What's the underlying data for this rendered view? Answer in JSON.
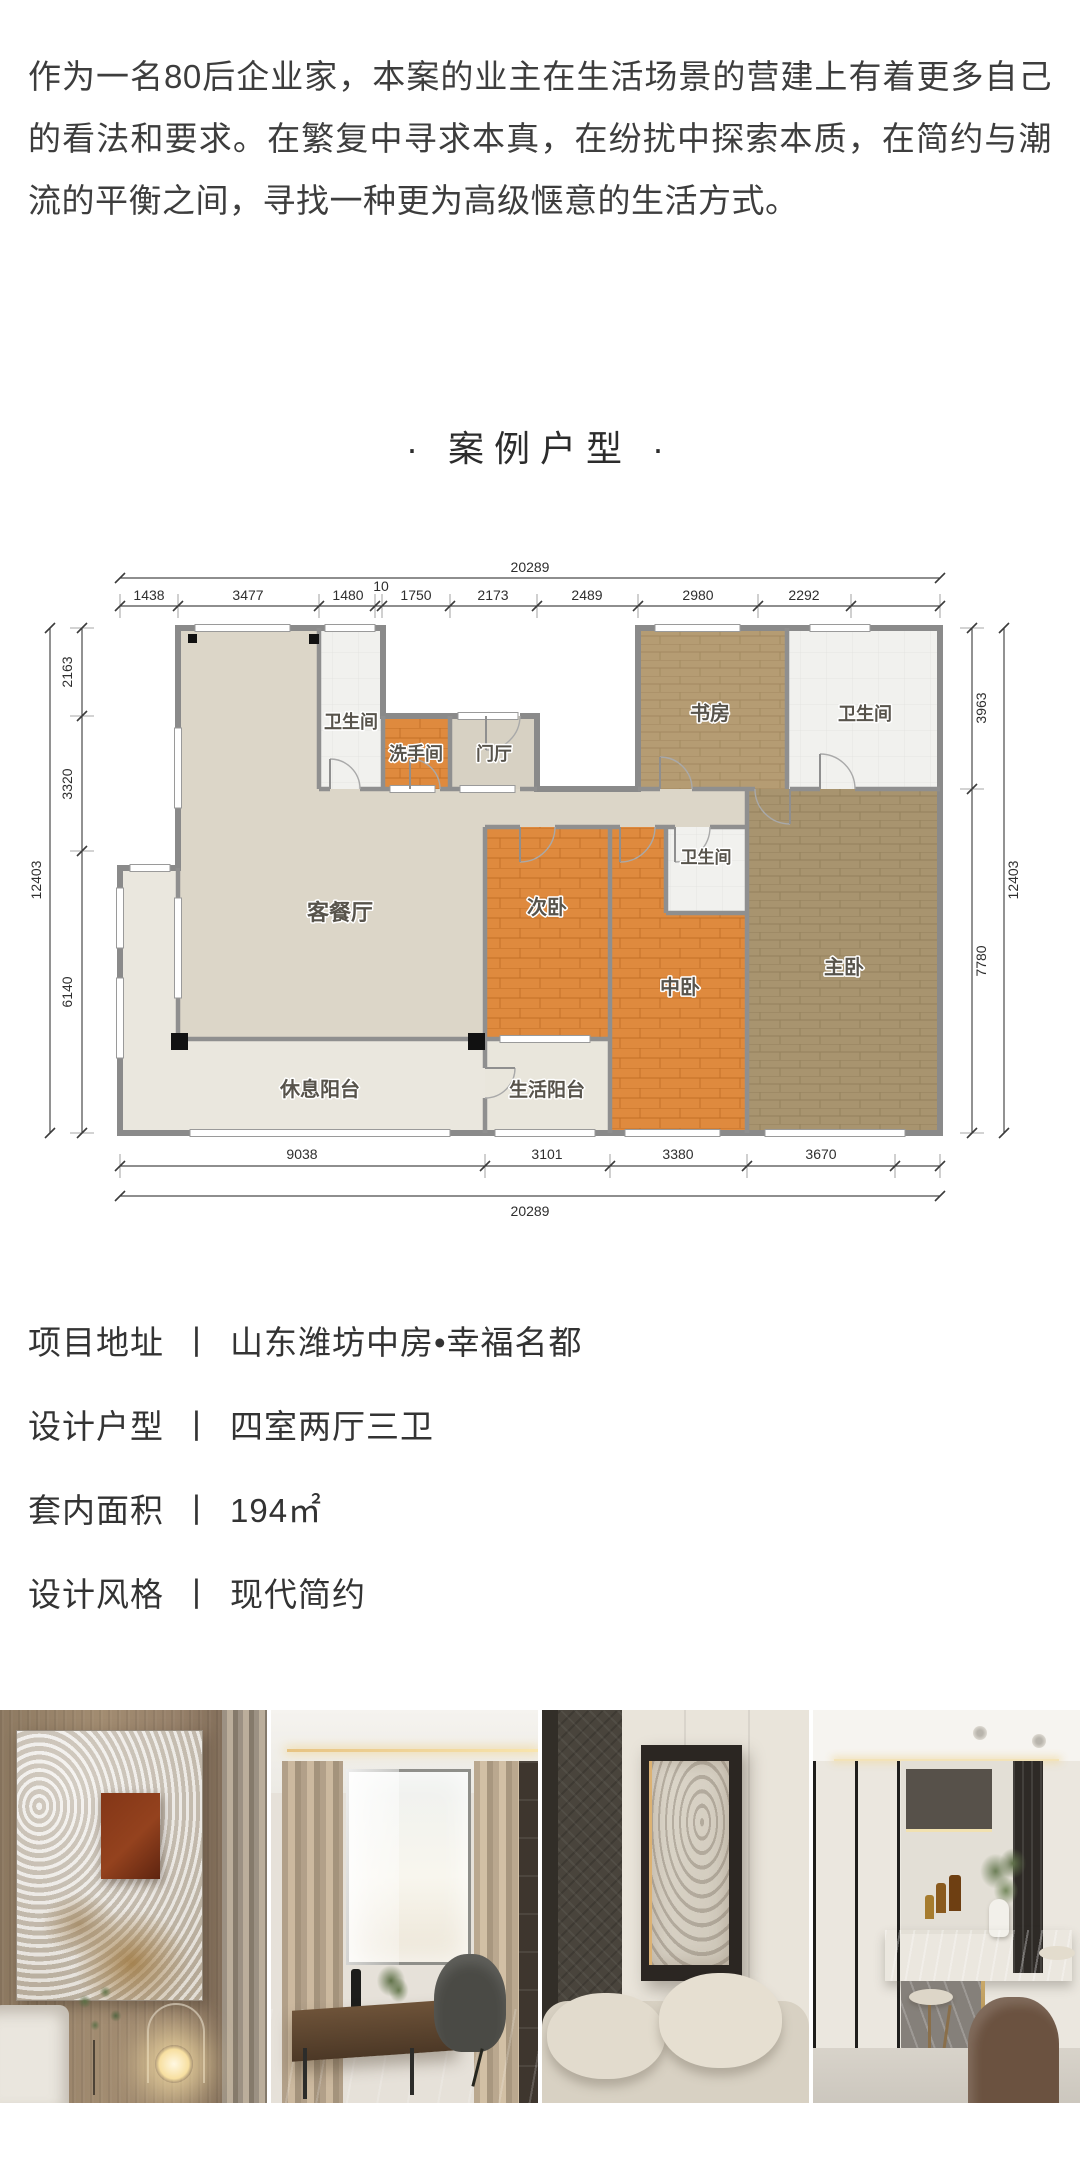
{
  "intro": {
    "text": "作为一名80后企业家，本案的业主在生活场景的营建上有着更多自己的看法和要求。在繁复中寻求本真，在纷扰中探索本质，在简约与潮流的平衡之间，寻找一种更为高级惬意的生活方式。"
  },
  "section_title": "· 案例户型 ·",
  "floorplan": {
    "rooms": {
      "living_dining": "客餐厅",
      "bath_top": "卫生间",
      "washroom": "洗手间",
      "foyer": "门厅",
      "study": "书房",
      "bath_right": "卫生间",
      "bath_mid": "卫生间",
      "second_bedroom": "次卧",
      "middle_bedroom": "中卧",
      "master_bedroom": "主卧",
      "rest_balcony": "休息阳台",
      "service_balcony": "生活阳台"
    },
    "dims": {
      "top_total": "20289",
      "top": [
        "1438",
        "3477",
        "1480",
        "10",
        "1750",
        "2173",
        "2489",
        "2980",
        "2292"
      ],
      "bottom": [
        "9038",
        "3101",
        "3380",
        "3670"
      ],
      "bottom_total": "20289",
      "left": [
        "2163",
        "3320",
        "6140"
      ],
      "left_total": "12403",
      "right": [
        "3963",
        "7780"
      ],
      "right_total": "12403"
    }
  },
  "project_info": {
    "separator": "丨",
    "items": [
      {
        "label": "项目地址",
        "value": "山东潍坊中房•幸福名都"
      },
      {
        "label": "设计户型",
        "value": "四室两厅三卫"
      },
      {
        "label": "套内面积",
        "value": "194㎡"
      },
      {
        "label": "设计风格",
        "value": "现代简约"
      }
    ]
  },
  "photos": [
    {
      "name": "bedroom-artwork-wall",
      "description": "卧室木饰面背景墙与肌理挂画、床头、球形灯"
    },
    {
      "name": "study-room",
      "description": "书房书桌、单椅、窗帘与窗景"
    },
    {
      "name": "living-room-relief-art",
      "description": "客厅浮雕艺术挂画与米色沙发"
    },
    {
      "name": "dining-bar-island",
      "description": "餐厨吧台、大理石中岛、吧椅与绿植"
    }
  ]
}
